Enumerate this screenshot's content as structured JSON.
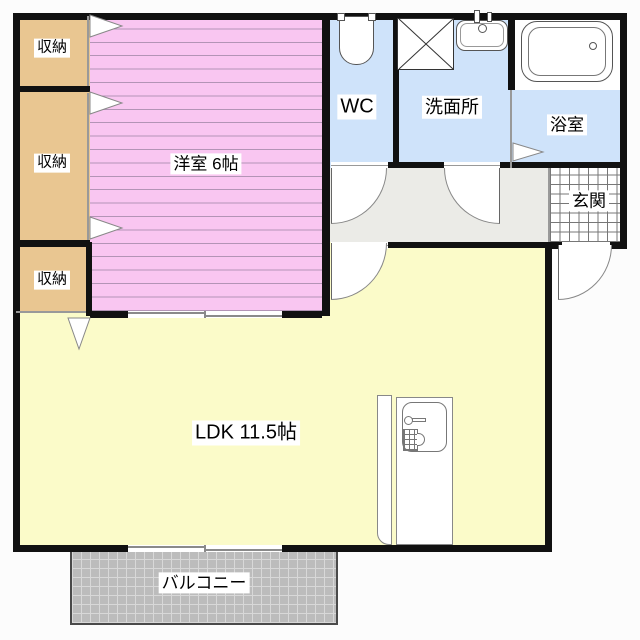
{
  "rooms": {
    "closet_top": {
      "label": "収納"
    },
    "closet_middle": {
      "label": "収納"
    },
    "closet_bottom": {
      "label": "収納"
    },
    "western_room": {
      "label": "洋室 6帖"
    },
    "wc": {
      "label": "WC"
    },
    "washroom": {
      "label": "洗面所"
    },
    "bathroom": {
      "label": "浴室"
    },
    "entrance": {
      "label": "玄関"
    },
    "ldk": {
      "label": "LDK 11.5帖"
    },
    "balcony": {
      "label": "バルコニー"
    }
  },
  "icons": {
    "toilet": "toilet-icon",
    "bathtub": "bathtub-icon",
    "washing_machine_pan": "washing-machine-pan-icon",
    "washbasin": "washbasin-icon",
    "kitchen_counter": "kitchen-counter-icon",
    "kitchen_sink": "kitchen-sink-icon"
  },
  "colors": {
    "wall": "#111111",
    "western": "#f9c6f1",
    "closet": "#e9c691",
    "wet": "#cfe3fa",
    "ldk": "#fbfbc9",
    "hallway": "#ebebe7",
    "balcony": "#bcbcbc",
    "bg": "#fcfcfc"
  }
}
